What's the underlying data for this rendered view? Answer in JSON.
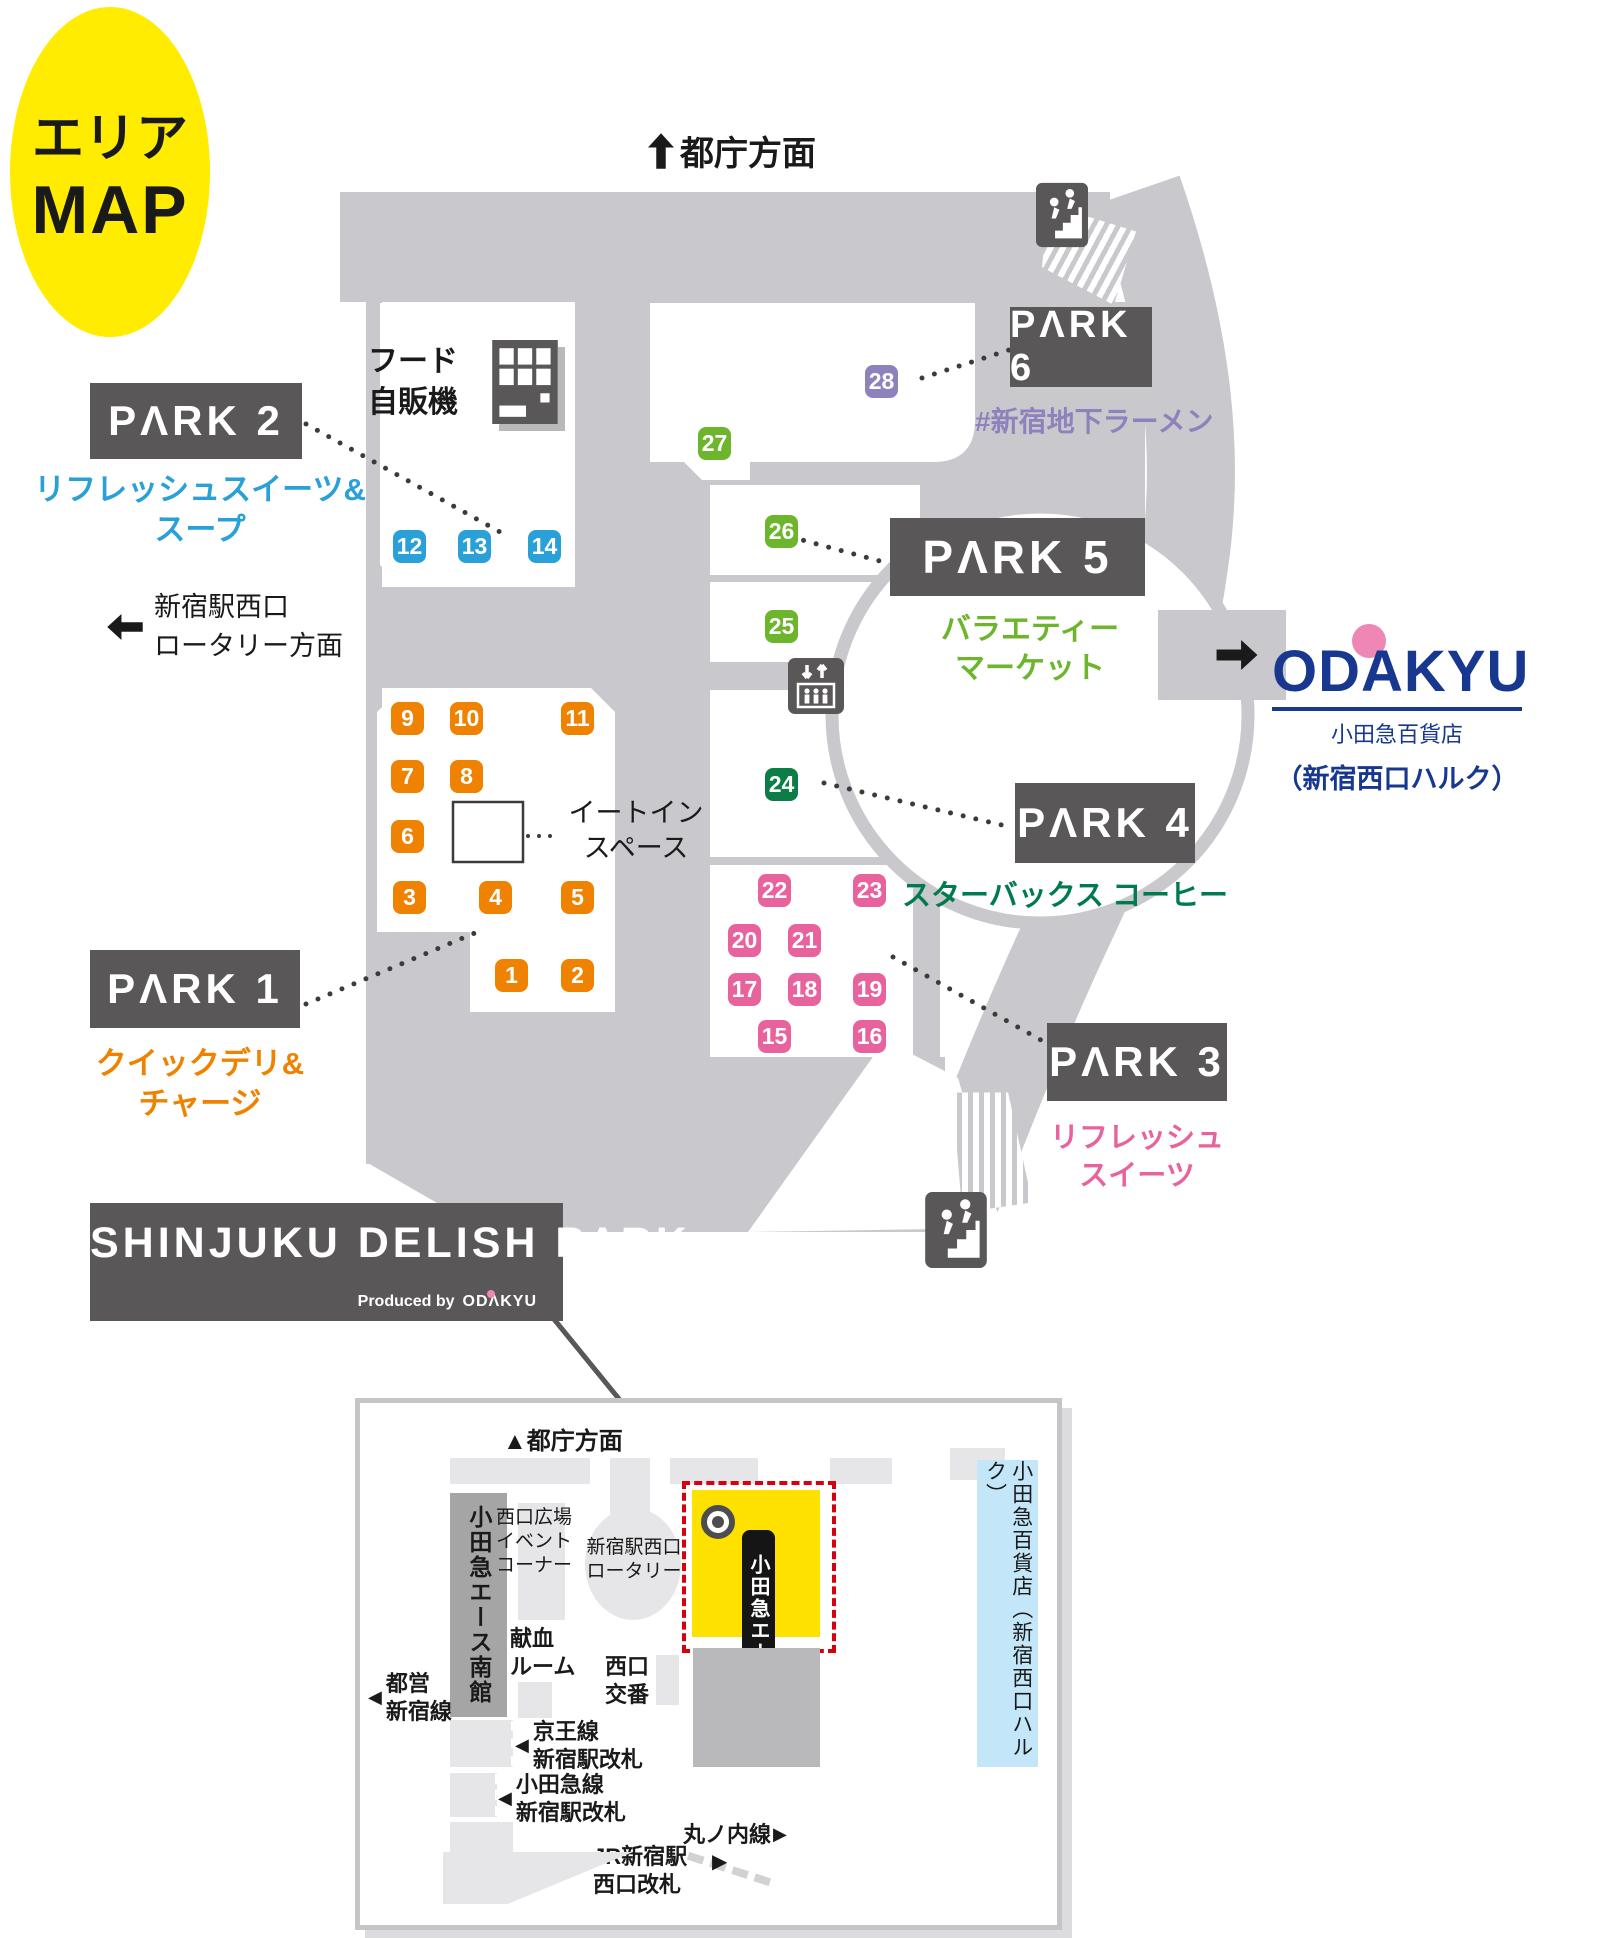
{
  "title_badge": {
    "line1": "エリア",
    "line2": "MAP"
  },
  "glyphs": {
    "up": "▲",
    "left": "◀",
    "right": "▶"
  },
  "directions": {
    "tocho": "都庁方面",
    "rotary": "新宿駅西口\nロータリー方面"
  },
  "vending_label": "フード\n自販機",
  "eat_in_label": "イートイン\nスペース",
  "parks": {
    "park1": {
      "label": "PΛRK 1",
      "subtitle": "クイックデリ&\nチャージ",
      "badges": [
        "1",
        "2",
        "3",
        "4",
        "5",
        "6",
        "7",
        "8",
        "9",
        "10",
        "11"
      ]
    },
    "park2": {
      "label": "PΛRK 2",
      "subtitle": "リフレッシュスイーツ&\nスープ",
      "badges": [
        "12",
        "13",
        "14"
      ]
    },
    "park3": {
      "label": "PΛRK 3",
      "subtitle": "リフレッシュ\nスイーツ",
      "badges": [
        "15",
        "16",
        "17",
        "18",
        "19",
        "20",
        "21",
        "22",
        "23"
      ]
    },
    "park4": {
      "label": "PΛRK 4",
      "subtitle": "スターバックス コーヒー",
      "badges": [
        "24"
      ]
    },
    "park5": {
      "label": "PΛRK 5",
      "subtitle": "バラエティー\nマーケット",
      "badges": [
        "25",
        "26",
        "27"
      ]
    },
    "park6": {
      "label": "PΛRK 6",
      "subtitle": "#新宿地下ラーメン",
      "badges": [
        "28"
      ]
    }
  },
  "odakyu": {
    "logo": "ODAKYU",
    "store": "小田急百貨店",
    "building": "（新宿西口ハルク）"
  },
  "banner": {
    "title": "SHINJUKU DELISH PΛRK",
    "produced_by": "Produced by",
    "brand": "ODΛKYU"
  },
  "inset": {
    "direction_top": "都庁方面",
    "ace_south": "小田急エース南館",
    "event_corner": "西口広場\nイベント\nコーナー",
    "rotary": "新宿駅西口\nロータリー",
    "ace_north": "小田急エース北館",
    "dept_store": "小田急百貨店（新宿西口ハルク）",
    "blood_room": "献血\nルーム",
    "police": "西口\n交番",
    "toei": "都営\n新宿線",
    "keio": "京王線\n新宿駅改札",
    "odakyu_line": "小田急線\n新宿駅改札",
    "jr": "JR新宿駅\n西口改札",
    "marunouchi": "丸ノ内線"
  },
  "colors": {
    "floor_gray": "#c9c9cd",
    "label_gray": "#595757",
    "park1_orange": "#ef8200",
    "park2_blue": "#29a0d8",
    "park3_pink": "#e8639d",
    "park4_green": "#0d7d48",
    "park5_green": "#6db52c",
    "park6_purple": "#8f82bc",
    "odakyu_blue": "#17388e",
    "odakyu_pink": "#ee87b4",
    "map_yellow": "#ffec00",
    "inset_yellow": "#ffe100",
    "alert_red": "#d7000f"
  }
}
